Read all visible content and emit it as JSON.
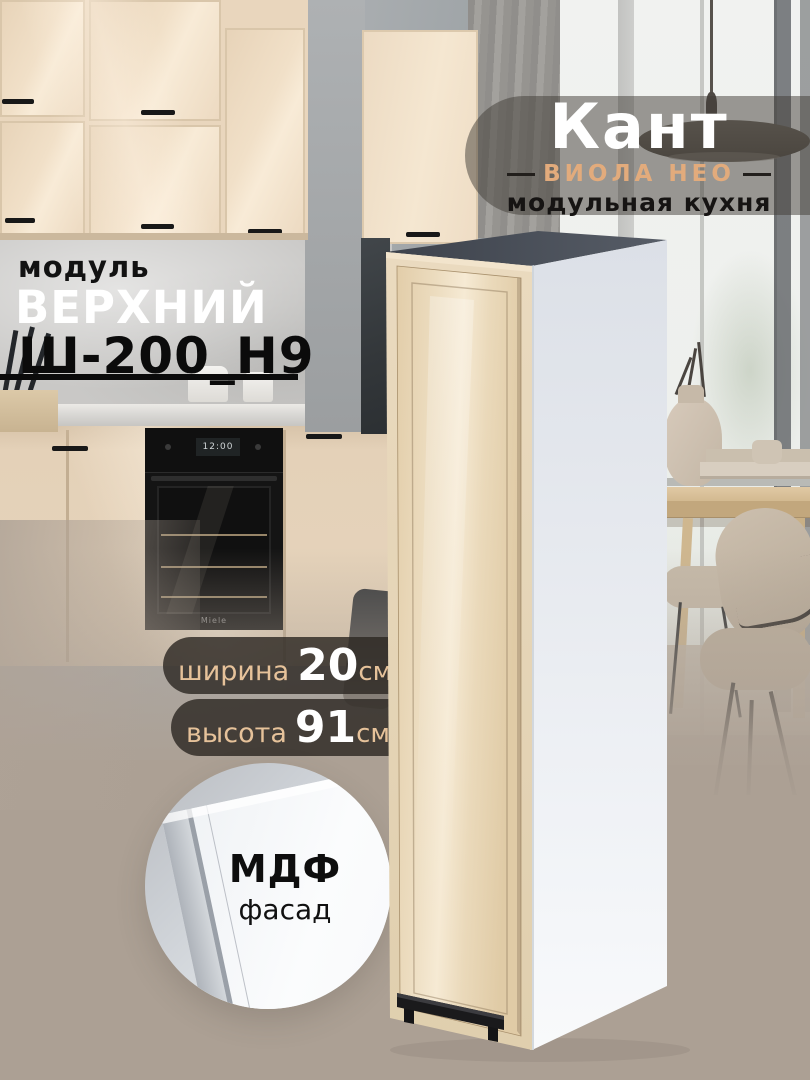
{
  "brand": {
    "title": "Кант",
    "series": "ВИОЛА НЕО",
    "tagline": "модульная кухня"
  },
  "module": {
    "label": "модуль",
    "name": "ВЕРХНИЙ",
    "code": "Ш-200_Н9"
  },
  "specs": [
    {
      "label": "ширина",
      "value": "20",
      "unit": "см"
    },
    {
      "label": "высота",
      "value": "91",
      "unit": "см"
    }
  ],
  "material": {
    "title": "МДФ",
    "subtitle": "фасад"
  },
  "oven": {
    "display": "12:00",
    "brand": "Miele"
  },
  "colors": {
    "accent_peach": "#e2ab7c",
    "badge_text_peach": "#e6c29a",
    "pill_dark": "rgba(45,40,35,0.82)",
    "title_pill": "rgba(64,59,53,0.5)",
    "background_taupe": "#aca094",
    "facade_beige": "#ecdcbf",
    "cabinet_side_white": "#eef1f5",
    "cabinet_top_gray": "#474c55",
    "text_dark": "#121212",
    "text_white": "#ffffff"
  }
}
